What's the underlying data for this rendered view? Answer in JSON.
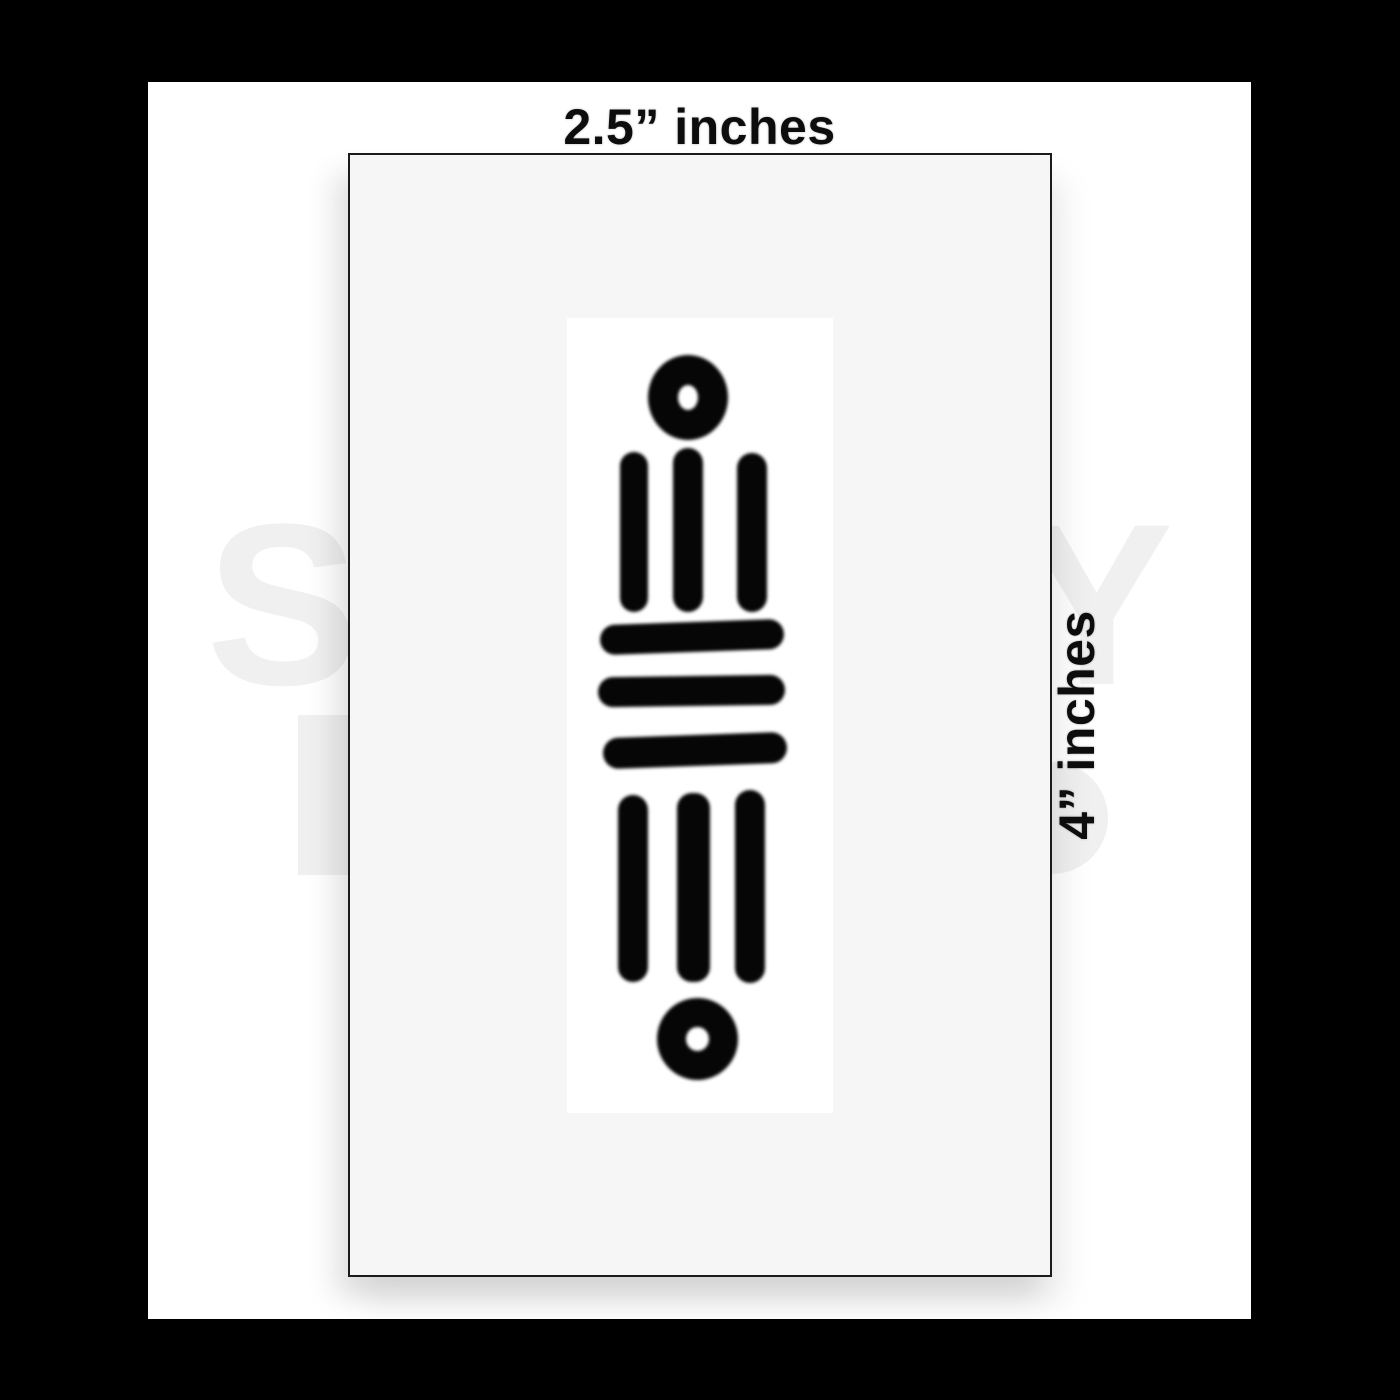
{
  "labels": {
    "width": "2.5” inches",
    "height": "4” inches"
  },
  "watermark": {
    "letters": [
      "S",
      "Y"
    ],
    "color": "#f0f0f0"
  },
  "colors": {
    "canvas": "#000000",
    "background": "#ffffff",
    "sheet": "#f6f6f7",
    "sheet_border": "#1b1b1b",
    "paper": "#ffffff",
    "ink": "#060606",
    "label_text": "#0d0d0d"
  },
  "design": {
    "name": "aztec-maya-numeral-tattoo-symbol",
    "parts": [
      "top-ring",
      "three-upper-vertical-bars",
      "three-middle-horizontal-bars",
      "three-lower-vertical-bars",
      "bottom-ring"
    ]
  }
}
